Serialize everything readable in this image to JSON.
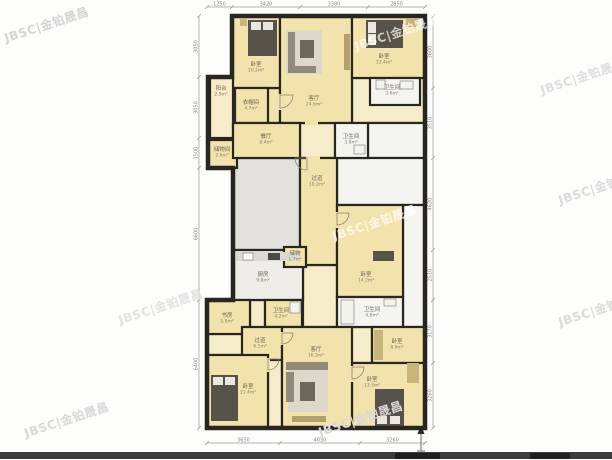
{
  "watermark_text": "JBSC|金铂晟昌",
  "palette": {
    "wall": "#29251f",
    "tan": "#f2e2ab",
    "tanlight": "#f6ecca",
    "gray": "#e2e1dc",
    "white": "#f4f4f1",
    "kitchen": "#eeede8"
  },
  "plan": {
    "outline": "232,16 425,16 425,428 207,428 207,300 233,300 233,168 208,168 208,77 232,77",
    "rooms": [
      {
        "name": "hall-top-right",
        "x": 352,
        "y": 78,
        "w": 73,
        "h": 45,
        "floor": "tanlight",
        "label": "",
        "area": ""
      },
      {
        "name": "living-ext",
        "x": 266,
        "y": 88,
        "w": 14,
        "h": 35,
        "floor": "tan",
        "label": "",
        "area": ""
      },
      {
        "name": "hall-strip-top",
        "x": 300,
        "y": 123,
        "w": 35,
        "h": 35,
        "floor": "tanlight",
        "label": "",
        "area": ""
      },
      {
        "name": "void-right-1",
        "x": 368,
        "y": 123,
        "w": 57,
        "h": 35,
        "floor": "white",
        "label": "",
        "area": ""
      },
      {
        "name": "void-right-2",
        "x": 337,
        "y": 158,
        "w": 88,
        "h": 47,
        "floor": "white",
        "label": "",
        "area": ""
      },
      {
        "name": "void-right-3",
        "x": 403,
        "y": 205,
        "w": 22,
        "h": 122,
        "floor": "white",
        "label": "",
        "area": ""
      },
      {
        "name": "hall-widen",
        "x": 288,
        "y": 158,
        "w": 12,
        "h": 20,
        "floor": "tanlight",
        "label": "",
        "area": ""
      },
      {
        "name": "public-hall",
        "x": 233,
        "y": 158,
        "w": 67,
        "h": 92,
        "floor": "gray",
        "label": "",
        "area": ""
      },
      {
        "name": "corridor-mid",
        "x": 303,
        "y": 265,
        "w": 34,
        "h": 62,
        "floor": "tanlight",
        "label": "",
        "area": ""
      },
      {
        "name": "hall-right-small",
        "x": 337,
        "y": 327,
        "w": 35,
        "h": 36,
        "floor": "tanlight",
        "label": "",
        "area": ""
      },
      {
        "name": "study-filler",
        "x": 207,
        "y": 334,
        "w": 43,
        "h": 21,
        "floor": "tanlight",
        "label": "",
        "area": ""
      },
      {
        "name": "bath-filler",
        "x": 250,
        "y": 300,
        "w": 15,
        "h": 34,
        "floor": "tanlight",
        "label": "",
        "area": ""
      },
      {
        "name": "hall-bl",
        "x": 268,
        "y": 355,
        "w": 14,
        "h": 73,
        "floor": "tanlight",
        "label": "",
        "area": ""
      },
      {
        "name": "bedroom-top-left",
        "x": 232,
        "y": 16,
        "w": 48,
        "h": 72,
        "floor": "tan",
        "label": "卧室",
        "area": "10.2m²",
        "lx": 256,
        "ly": 66
      },
      {
        "name": "living-top",
        "x": 280,
        "y": 16,
        "w": 72,
        "h": 107,
        "floor": "tan",
        "label": "客厅",
        "area": "24.6m²",
        "lx": 314,
        "ly": 100
      },
      {
        "name": "bedroom-top-right",
        "x": 352,
        "y": 16,
        "w": 73,
        "h": 62,
        "floor": "tan",
        "label": "卧室",
        "area": "12.4m²",
        "lx": 384,
        "ly": 58
      },
      {
        "name": "bath-top-right",
        "x": 370,
        "y": 78,
        "w": 50,
        "h": 27,
        "floor": "white",
        "label": "卫生间",
        "area": "3.6m²",
        "lx": 392,
        "ly": 89
      },
      {
        "name": "closet-upper",
        "x": 235,
        "y": 88,
        "w": 33,
        "h": 35,
        "floor": "tan",
        "label": "衣帽间",
        "area": "4.7m²",
        "lx": 251,
        "ly": 104
      },
      {
        "name": "balcony",
        "x": 210,
        "y": 77,
        "w": 23,
        "h": 61,
        "floor": "tanlight",
        "label": "阳台",
        "area": "2.9m²",
        "lx": 221,
        "ly": 90
      },
      {
        "name": "storeroom-left",
        "x": 208,
        "y": 140,
        "w": 29,
        "h": 28,
        "floor": "tan",
        "label": "储物间",
        "area": "2.6m²",
        "lx": 222,
        "ly": 151
      },
      {
        "name": "dining",
        "x": 233,
        "y": 123,
        "w": 67,
        "h": 35,
        "floor": "tan",
        "label": "餐厅",
        "area": "8.4m²",
        "lx": 266,
        "ly": 138
      },
      {
        "name": "bath-center",
        "x": 335,
        "y": 123,
        "w": 33,
        "h": 35,
        "floor": "white",
        "label": "卫生间",
        "area": "3.8m²",
        "lx": 351,
        "ly": 138
      },
      {
        "name": "hallway",
        "x": 300,
        "y": 158,
        "w": 37,
        "h": 107,
        "floor": "tan",
        "label": "过道",
        "area": "10.2m²",
        "lx": 317,
        "ly": 180
      },
      {
        "name": "kitchen",
        "x": 233,
        "y": 250,
        "w": 70,
        "h": 50,
        "floor": "kitchen",
        "label": "厨房",
        "area": "9.8m²",
        "lx": 263,
        "ly": 276
      },
      {
        "name": "closet-small",
        "x": 284,
        "y": 247,
        "w": 22,
        "h": 20,
        "floor": "tan",
        "label": "储物",
        "area": "1.7m²",
        "lx": 295,
        "ly": 255
      },
      {
        "name": "bedroom-mid-right",
        "x": 337,
        "y": 205,
        "w": 66,
        "h": 92,
        "floor": "tan",
        "label": "卧室",
        "area": "14.2m²",
        "lx": 366,
        "ly": 276
      },
      {
        "name": "bath-mid-right",
        "x": 337,
        "y": 297,
        "w": 66,
        "h": 30,
        "floor": "white",
        "label": "卫生间",
        "area": "4.8m²",
        "lx": 372,
        "ly": 311
      },
      {
        "name": "bedroom-right-small",
        "x": 372,
        "y": 327,
        "w": 53,
        "h": 36,
        "floor": "tan",
        "label": "卧室",
        "area": "8.9m²",
        "lx": 397,
        "ly": 343
      },
      {
        "name": "bedroom-bottom-right",
        "x": 352,
        "y": 363,
        "w": 73,
        "h": 65,
        "floor": "tan",
        "label": "卧室",
        "area": "13.3m²",
        "lx": 372,
        "ly": 381
      },
      {
        "name": "study-bottom-left",
        "x": 207,
        "y": 300,
        "w": 43,
        "h": 34,
        "floor": "tan",
        "label": "书房",
        "area": "5.6m²",
        "lx": 227,
        "ly": 317
      },
      {
        "name": "bath-bottom",
        "x": 265,
        "y": 300,
        "w": 37,
        "h": 27,
        "floor": "tan",
        "label": "卫生间",
        "area": "4.2m²",
        "lx": 281,
        "ly": 312
      },
      {
        "name": "hallway-bottom",
        "x": 242,
        "y": 327,
        "w": 40,
        "h": 33,
        "floor": "tan",
        "label": "过道",
        "area": "6.1m²",
        "lx": 260,
        "ly": 342
      },
      {
        "name": "living-bottom",
        "x": 282,
        "y": 327,
        "w": 70,
        "h": 101,
        "floor": "tan",
        "label": "客厅",
        "area": "16.2m²",
        "lx": 316,
        "ly": 351
      },
      {
        "name": "bedroom-bottom-left",
        "x": 207,
        "y": 355,
        "w": 61,
        "h": 73,
        "floor": "tan",
        "label": "卧室",
        "area": "11.4m²",
        "lx": 248,
        "ly": 388
      }
    ],
    "door_gaps": [
      {
        "x": 278,
        "y": 94,
        "w": 4,
        "h": 16,
        "floor": "tan"
      },
      {
        "x": 335,
        "y": 212,
        "w": 4,
        "h": 16,
        "floor": "tan"
      },
      {
        "x": 350,
        "y": 366,
        "w": 4,
        "h": 16,
        "floor": "tan"
      },
      {
        "x": 266,
        "y": 358,
        "w": 4,
        "h": 14,
        "floor": "tan"
      },
      {
        "x": 280,
        "y": 332,
        "w": 4,
        "h": 13,
        "floor": "tan"
      },
      {
        "x": 306,
        "y": 156,
        "w": 14,
        "h": 4,
        "floor": "tan"
      },
      {
        "x": 305,
        "y": 121,
        "w": 13,
        "h": 4,
        "floor": "tan"
      }
    ],
    "doors": [
      {
        "cx": 280,
        "cy": 95,
        "r": 13,
        "rot": 0
      },
      {
        "cx": 337,
        "cy": 213,
        "r": 12,
        "rot": 0
      },
      {
        "cx": 352,
        "cy": 367,
        "r": 12,
        "rot": 0
      },
      {
        "cx": 268,
        "cy": 359,
        "r": 11,
        "rot": 0
      },
      {
        "cx": 282,
        "cy": 333,
        "r": 11,
        "rot": 0
      },
      {
        "cx": 307,
        "cy": 158,
        "r": 12,
        "rot": 90
      }
    ],
    "furniture": [
      {
        "name": "bed-top-left",
        "x": 248,
        "y": 20,
        "w": 29,
        "h": 36,
        "fill": "#57534a"
      },
      {
        "name": "pillow",
        "x": 251,
        "y": 22,
        "w": 10,
        "h": 8,
        "fill": "#e8e6df"
      },
      {
        "name": "pillow",
        "x": 263,
        "y": 22,
        "w": 10,
        "h": 8,
        "fill": "#e8e6df"
      },
      {
        "name": "nightstand",
        "x": 240,
        "y": 19,
        "w": 7,
        "h": 7,
        "fill": "#c8b57c"
      },
      {
        "name": "rug-top-living",
        "x": 286,
        "y": 30,
        "w": 36,
        "h": 44,
        "fill": "#ded8c8"
      },
      {
        "name": "sofa-top-back",
        "x": 288,
        "y": 32,
        "w": 7,
        "h": 40,
        "fill": "#91897a"
      },
      {
        "name": "sofa-top-seat",
        "x": 288,
        "y": 66,
        "w": 28,
        "h": 7,
        "fill": "#91897a"
      },
      {
        "name": "coffee-table-top",
        "x": 300,
        "y": 40,
        "w": 14,
        "h": 18,
        "fill": "#6e6759"
      },
      {
        "name": "tv-cabinet-top",
        "x": 344,
        "y": 34,
        "w": 6,
        "h": 36,
        "fill": "#b3a070"
      },
      {
        "name": "bed-top-right",
        "x": 366,
        "y": 20,
        "w": 37,
        "h": 28,
        "fill": "#57534a"
      },
      {
        "name": "pillow",
        "x": 368,
        "y": 22,
        "w": 8,
        "h": 11,
        "fill": "#e8e6df"
      },
      {
        "name": "pillow",
        "x": 368,
        "y": 34,
        "w": 8,
        "h": 11,
        "fill": "#e8e6df"
      },
      {
        "name": "wardrobe-top-right",
        "x": 406,
        "y": 19,
        "w": 12,
        "h": 8,
        "fill": "#c8b57c"
      },
      {
        "name": "bath-sink",
        "x": 400,
        "y": 81,
        "w": 13,
        "h": 8,
        "fill": "#f2f2ef",
        "stroke": "#8a8a84"
      },
      {
        "name": "toilet",
        "x": 376,
        "y": 80,
        "w": 9,
        "h": 9,
        "fill": "#f2f2ef",
        "stroke": "#8a8a84"
      },
      {
        "name": "bath-fixture",
        "x": 354,
        "y": 145,
        "w": 11,
        "h": 9,
        "fill": "#f2f2ef",
        "stroke": "#8a8a84"
      },
      {
        "name": "kitchen-counter",
        "x": 236,
        "y": 252,
        "w": 64,
        "h": 9,
        "fill": "#dbd9d1"
      },
      {
        "name": "kitchen-sink",
        "x": 243,
        "y": 253,
        "w": 10,
        "h": 7,
        "fill": "#ffffff",
        "stroke": "#8a8a84"
      },
      {
        "name": "stove",
        "x": 268,
        "y": 253,
        "w": 12,
        "h": 7,
        "fill": "#4a4a46"
      },
      {
        "name": "desk-mid-right",
        "x": 373,
        "y": 251,
        "w": 21,
        "h": 10,
        "fill": "#57534a"
      },
      {
        "name": "bathtub",
        "x": 341,
        "y": 300,
        "w": 13,
        "h": 24,
        "fill": "#f2f2ef",
        "stroke": "#8a8a84"
      },
      {
        "name": "bath-sink",
        "x": 384,
        "y": 299,
        "w": 12,
        "h": 7,
        "fill": "#f2f2ef",
        "stroke": "#8a8a84"
      },
      {
        "name": "toilet",
        "x": 290,
        "y": 302,
        "w": 10,
        "h": 11,
        "fill": "#f2f2ef",
        "stroke": "#8a8a84"
      },
      {
        "name": "wardrobe-right-small",
        "x": 374,
        "y": 330,
        "w": 9,
        "h": 30,
        "fill": "#c8b57c"
      },
      {
        "name": "bed-bottom-left",
        "x": 211,
        "y": 375,
        "w": 27,
        "h": 46,
        "fill": "#57534a"
      },
      {
        "name": "pillow",
        "x": 213,
        "y": 377,
        "w": 10,
        "h": 8,
        "fill": "#e8e6df"
      },
      {
        "name": "pillow",
        "x": 225,
        "y": 377,
        "w": 10,
        "h": 8,
        "fill": "#e8e6df"
      },
      {
        "name": "rug-bottom-living",
        "x": 288,
        "y": 366,
        "w": 40,
        "h": 46,
        "fill": "#ded8c8"
      },
      {
        "name": "sofa-bottom-back",
        "x": 286,
        "y": 362,
        "w": 42,
        "h": 8,
        "fill": "#91897a"
      },
      {
        "name": "sofa-bottom-side",
        "x": 286,
        "y": 372,
        "w": 8,
        "h": 30,
        "fill": "#91897a"
      },
      {
        "name": "coffee-table-bottom",
        "x": 300,
        "y": 382,
        "w": 15,
        "h": 19,
        "fill": "#6e6759"
      },
      {
        "name": "tv-cabinet-bottom",
        "x": 292,
        "y": 416,
        "w": 34,
        "h": 6,
        "fill": "#b3a070"
      },
      {
        "name": "bed-bottom-right",
        "x": 375,
        "y": 389,
        "w": 29,
        "h": 37,
        "fill": "#57534a"
      },
      {
        "name": "pillow",
        "x": 377,
        "y": 416,
        "w": 10,
        "h": 8,
        "fill": "#e8e6df"
      },
      {
        "name": "pillow",
        "x": 390,
        "y": 416,
        "w": 10,
        "h": 8,
        "fill": "#e8e6df"
      },
      {
        "name": "wardrobe-bottom-right",
        "x": 407,
        "y": 363,
        "w": 12,
        "h": 20,
        "fill": "#c8b57c"
      }
    ],
    "dimensions": [
      {
        "orient": "h",
        "y": 7,
        "ticks": [
          207,
          232,
          300,
          368,
          425
        ],
        "labels": [
          "1250",
          "3420",
          "3380",
          "2850"
        ]
      },
      {
        "orient": "h",
        "y": 443,
        "ticks": [
          207,
          280,
          360,
          425
        ],
        "labels": [
          "3650",
          "4030",
          "3260"
        ]
      },
      {
        "orient": "v",
        "x": 433,
        "ticks": [
          16,
          88,
          158,
          250,
          300,
          363,
          428
        ],
        "labels": [
          "3600",
          "3510",
          "4620",
          "2510",
          "3170",
          "3260"
        ]
      },
      {
        "orient": "v",
        "x": 199,
        "ticks": [
          16,
          77,
          138,
          168,
          300,
          428
        ],
        "labels": [
          "3050",
          "3050",
          "1500",
          "6600",
          "6400"
        ]
      }
    ]
  },
  "watermarks": [
    {
      "x": 2,
      "y": 30,
      "color": "#d4d4d4"
    },
    {
      "x": 22,
      "y": 425,
      "color": "#d8d8d8"
    },
    {
      "x": 316,
      "y": 424,
      "color": "#d8d8d8"
    },
    {
      "x": 538,
      "y": 82,
      "color": "#dedede"
    },
    {
      "x": 556,
      "y": 192,
      "color": "#dadada"
    },
    {
      "x": 556,
      "y": 314,
      "color": "#dadada"
    },
    {
      "x": 352,
      "y": 38,
      "color": "rgba(255,255,255,0.7)"
    },
    {
      "x": 330,
      "y": 228,
      "color": "rgba(255,255,255,0.75)"
    },
    {
      "x": 116,
      "y": 312,
      "color": "#e2e2e2"
    }
  ]
}
